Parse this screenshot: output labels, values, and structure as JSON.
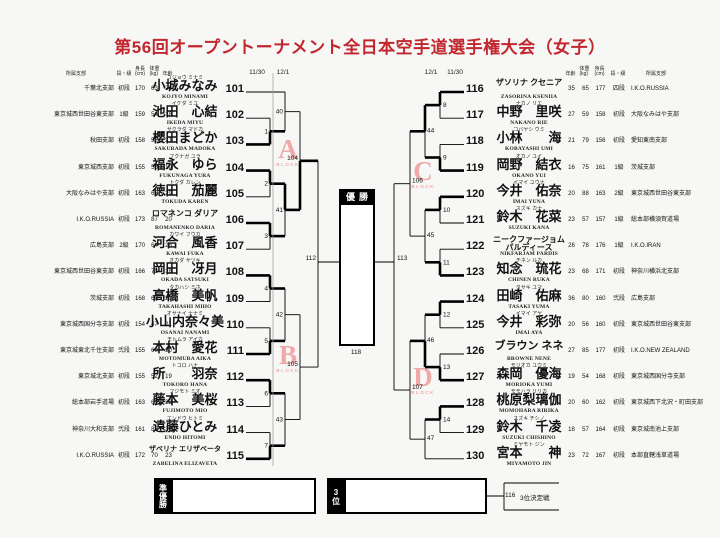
{
  "title": "第56回オープントーナメント全日本空手道選手権大会（女子）",
  "colors": {
    "title": "#c2262e",
    "line": "#000000",
    "watermark": "#f0a8a8"
  },
  "dates": {
    "left_outer": "11/30",
    "left_inner": "12/1",
    "right_inner": "12/1",
    "right_outer": "11/30"
  },
  "columns_left": [
    "所属支部",
    "段・級",
    "身長\n(cm)",
    "体重\n(kg)",
    "年齢"
  ],
  "columns_right": [
    "年齢",
    "体重\n(kg)",
    "身長\n(cm)",
    "段・級",
    "所属支部"
  ],
  "players_left": [
    {
      "no": "101",
      "furigana": "コジョウ ミナミ",
      "name": "小城みなみ",
      "romaji": "KOJYO MINAMI",
      "branch": "千葉北支部",
      "rank": "初段",
      "height": "170",
      "weight": "63",
      "age": "20"
    },
    {
      "no": "102",
      "furigana": "イケダ ミユ",
      "name": "池田　心結",
      "romaji": "IKEDA MIYU",
      "branch": "東京城西世田谷東支部",
      "rank": "1級",
      "height": "159",
      "weight": "54",
      "age": "18"
    },
    {
      "no": "103",
      "furigana": "サクラダ マドカ",
      "name": "櫻田まどか",
      "romaji": "SAKURADA MADOKA",
      "branch": "秋田支部",
      "rank": "初段",
      "height": "158",
      "weight": "52",
      "age": "21"
    },
    {
      "no": "104",
      "furigana": "フクナガ ユラ",
      "name": "福永　ゆら",
      "romaji": "FUKUNAGA YURA",
      "branch": "東京城西支部",
      "rank": "初段",
      "height": "155",
      "weight": "55",
      "age": "19"
    },
    {
      "no": "105",
      "furigana": "トクダ カレン",
      "name": "徳田　茄麗",
      "romaji": "TOKUDA KAREN",
      "branch": "大阪なみはや支部",
      "rank": "初段",
      "height": "163",
      "weight": "63",
      "age": "29"
    },
    {
      "no": "106",
      "furigana": "",
      "name": "ロマネンコ ダリア",
      "romaji": "ROMANENKO DARIA",
      "branch": "I.K.O.RUSSIA",
      "rank": "初段",
      "height": "173",
      "weight": "87",
      "age": "20"
    },
    {
      "no": "107",
      "furigana": "カワイ フウカ",
      "name": "河合　風香",
      "romaji": "KAWAI FUKA",
      "branch": "広島支部",
      "rank": "2級",
      "height": "170",
      "weight": "64",
      "age": "26"
    },
    {
      "no": "108",
      "furigana": "オカダ サツキ",
      "name": "岡田　冴月",
      "romaji": "OKADA SATSUKI",
      "branch": "東京城西世田谷東支部",
      "rank": "初段",
      "height": "166",
      "weight": "72",
      "age": "18"
    },
    {
      "no": "109",
      "furigana": "タカハシ ミホ",
      "name": "高橋　美帆",
      "romaji": "TAKAHASHI MIHO",
      "branch": "茨城支部",
      "rank": "初段",
      "height": "168",
      "weight": "60",
      "age": "20"
    },
    {
      "no": "110",
      "furigana": "オサナイ ナナミ",
      "name": "小山内奈々美",
      "romaji": "OSANAI NANAMI",
      "branch": "東京城西国分寺支部",
      "rank": "初段",
      "height": "154",
      "weight": "47",
      "age": "21"
    },
    {
      "no": "111",
      "furigana": "モトムラ アイカ",
      "name": "本村　愛花",
      "romaji": "MOTOMURA AIKA",
      "branch": "東京城東北千住支部",
      "rank": "弐段",
      "height": "155",
      "weight": "60",
      "age": "30"
    },
    {
      "no": "112",
      "furigana": "トコロ ハナ",
      "name": "所　　羽奈",
      "romaji": "TOKORO HANA",
      "branch": "東京城北支部",
      "rank": "初段",
      "height": "155",
      "weight": "52",
      "age": "19"
    },
    {
      "no": "113",
      "furigana": "フジモト ミオ",
      "name": "藤本　美桜",
      "romaji": "FUJIMOTO MIO",
      "branch": "総本部岩手道場",
      "rank": "初段",
      "height": "163",
      "weight": "62",
      "age": "22"
    },
    {
      "no": "114",
      "furigana": "エンドウ ヒトミ",
      "name": "遠藤ひとみ",
      "romaji": "ENDO HITOMI",
      "branch": "神奈川大和支部",
      "rank": "弐段",
      "height": "161",
      "weight": "83",
      "age": "30"
    },
    {
      "no": "115",
      "furigana": "",
      "name": "ザベリナ エリザベータ",
      "romaji": "ZABELINA ELIZAVETA",
      "branch": "I.K.O.RUSSIA",
      "rank": "初段",
      "height": "172",
      "weight": "70",
      "age": "23"
    }
  ],
  "players_right": [
    {
      "no": "116",
      "furigana": "",
      "name": "ザソリナ クセニア",
      "romaji": "ZASORINA KSENIIA",
      "branch": "I.K.O.RUSSIA",
      "rank": "四段",
      "height": "177",
      "weight": "65",
      "age": "35"
    },
    {
      "no": "117",
      "furigana": "ナカノ リエ",
      "name": "中野　里咲",
      "romaji": "NAKANO RIE",
      "branch": "大阪なみはや支部",
      "rank": "初段",
      "height": "158",
      "weight": "59",
      "age": "27"
    },
    {
      "no": "118",
      "furigana": "コバヤシ ウミ",
      "name": "小林　　海",
      "romaji": "KOBAYASHI UMI",
      "branch": "愛知東南支部",
      "rank": "初段",
      "height": "156",
      "weight": "79",
      "age": "21"
    },
    {
      "no": "119",
      "furigana": "オカノ ユイ",
      "name": "岡野　結衣",
      "romaji": "OKANO YUI",
      "branch": "茨城支部",
      "rank": "1級",
      "height": "161",
      "weight": "75",
      "age": "16"
    },
    {
      "no": "120",
      "furigana": "イマイ ユウナ",
      "name": "今井　佑奈",
      "romaji": "IMAI YUNA",
      "branch": "東京城西世田谷東支部",
      "rank": "2級",
      "height": "163",
      "weight": "88",
      "age": "20"
    },
    {
      "no": "121",
      "furigana": "スズキ カナ",
      "name": "鈴木　花菜",
      "romaji": "SUZUKI KANA",
      "branch": "総本部横須賀道場",
      "rank": "1級",
      "height": "157",
      "weight": "57",
      "age": "23"
    },
    {
      "no": "122",
      "furigana": "",
      "name": "ニークファージョム\nパルディース",
      "romaji": "NIKFARJAM PARDIS",
      "branch": "I.K.O.IRAN",
      "rank": "1級",
      "height": "176",
      "weight": "78",
      "age": "26"
    },
    {
      "no": "123",
      "furigana": "チネン ルカ",
      "name": "知念　琉花",
      "romaji": "CHINEN RUKA",
      "branch": "神奈川横浜北支部",
      "rank": "初段",
      "height": "171",
      "weight": "68",
      "age": "23"
    },
    {
      "no": "124",
      "furigana": "タサキ ユマ",
      "name": "田崎　佑麻",
      "romaji": "TASAKI YUMA",
      "branch": "広島支部",
      "rank": "弐段",
      "height": "160",
      "weight": "80",
      "age": "36"
    },
    {
      "no": "125",
      "furigana": "イマイ アヤ",
      "name": "今井　彩弥",
      "romaji": "IMAI AYA",
      "branch": "東京城西世田谷東支部",
      "rank": "初段",
      "height": "160",
      "weight": "56",
      "age": "20"
    },
    {
      "no": "126",
      "furigana": "",
      "name": "ブラウン ネネ",
      "romaji": "BROWNE NENE",
      "branch": "I.K.O.NEW ZEALAND",
      "rank": "初段",
      "height": "177",
      "weight": "85",
      "age": "27"
    },
    {
      "no": "127",
      "furigana": "モリオカ ユウミ",
      "name": "森岡　優海",
      "romaji": "MORIOKA YUMI",
      "branch": "東京城西国分寺支部",
      "rank": "初段",
      "height": "168",
      "weight": "54",
      "age": "19"
    },
    {
      "no": "128",
      "furigana": "モモハラ リリカ",
      "name": "桃原梨璃伽",
      "romaji": "MOMOHARA RIRIKA",
      "branch": "東京城西下北沢・町田支部",
      "rank": "初段",
      "height": "162",
      "weight": "60",
      "age": "20"
    },
    {
      "no": "129",
      "furigana": "スズキ チシノ",
      "name": "鈴木　千凌",
      "romaji": "SUZUKI CHISHINO",
      "branch": "東京城南池上支部",
      "rank": "初段",
      "height": "164",
      "weight": "57",
      "age": "18"
    },
    {
      "no": "130",
      "furigana": "ミヤモト ジン",
      "name": "宮本　　神",
      "romaji": "MIYAMOTO JIN",
      "branch": "本部直轄浅草道場",
      "rank": "初段",
      "height": "167",
      "weight": "72",
      "age": "23"
    }
  ],
  "bracket": {
    "r1_left": [
      "1",
      "2",
      "3",
      "4",
      "5",
      "6",
      "7"
    ],
    "r2_left": [
      "40",
      "41",
      "42",
      "43"
    ],
    "r3_left": [
      "104",
      "105"
    ],
    "semi_left": "112",
    "r1_right": [
      "8",
      "9",
      "10",
      "11",
      "12",
      "13",
      "14"
    ],
    "r2_right": [
      "44",
      "45",
      "46",
      "47"
    ],
    "r3_right": [
      "106",
      "107"
    ],
    "semi_right": "113",
    "final_no": "118"
  },
  "results": {
    "r1_left": [
      "B",
      "T",
      "T",
      "T",
      "B",
      "T",
      "B"
    ],
    "r2_left": [
      "",
      "T",
      "",
      ""
    ],
    "r3_left": [
      "B",
      ""
    ],
    "r1_right": [
      "T",
      "B",
      "T",
      "B",
      "T",
      "B",
      "T"
    ],
    "r2_right": [
      "T",
      "",
      "B",
      ""
    ],
    "r3_right": [
      "",
      ""
    ]
  },
  "labels": {
    "champion": "優勝",
    "runner_up": "準優勝",
    "third": "3位",
    "third_match_no": "116",
    "third_match": "3位決定戦"
  },
  "blocks": [
    {
      "letter": "A",
      "sub": "BLOCK"
    },
    {
      "letter": "B",
      "sub": "BLOCK"
    },
    {
      "letter": "C",
      "sub": "BLOCK"
    },
    {
      "letter": "D",
      "sub": "BLOCK"
    }
  ]
}
